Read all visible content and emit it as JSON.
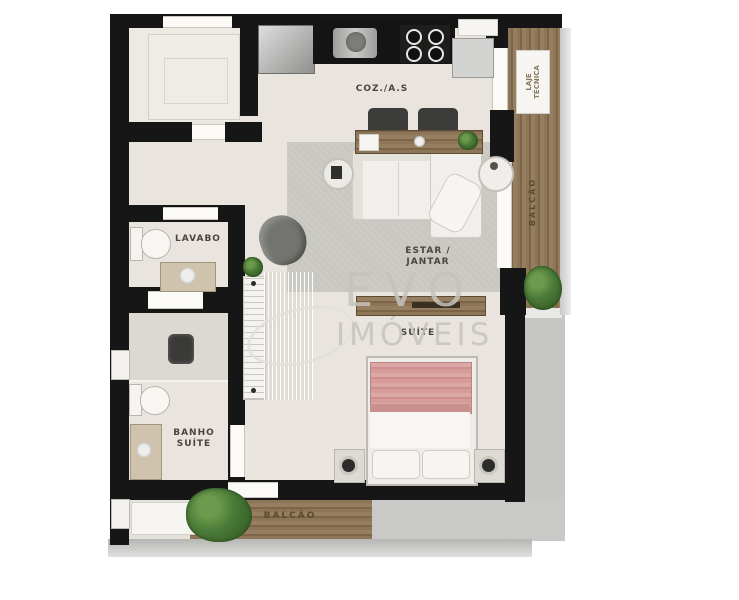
{
  "plan": {
    "type": "apartment-floor-plan",
    "labels": {
      "kitchen": "COZ./A.S",
      "living": "ESTAR /\nJANTAR",
      "suite": "SUÍTE",
      "lavabo": "LAVABO",
      "banho_suite": "BANHO\nSUÍTE",
      "balcony_bottom": "BALCÃO",
      "balcony_right": "BALCÃO",
      "laje_tecnica": "LAJE\nTÉCNICA"
    },
    "watermark": {
      "line1": "EVO",
      "line2": "IMÓVEIS"
    },
    "colors": {
      "wall": "#161616",
      "floor": "#e9e5de",
      "rug": "#c9c7c2",
      "wood_deck": "#8d7658",
      "bed_blanket": "#d79c9a",
      "plant": "#4a7a38",
      "exterior_shadow": "#c6c6c4",
      "railing": "#d8d8d6",
      "label_text": "#4a453e",
      "watermark": "#c6c3bc"
    }
  }
}
